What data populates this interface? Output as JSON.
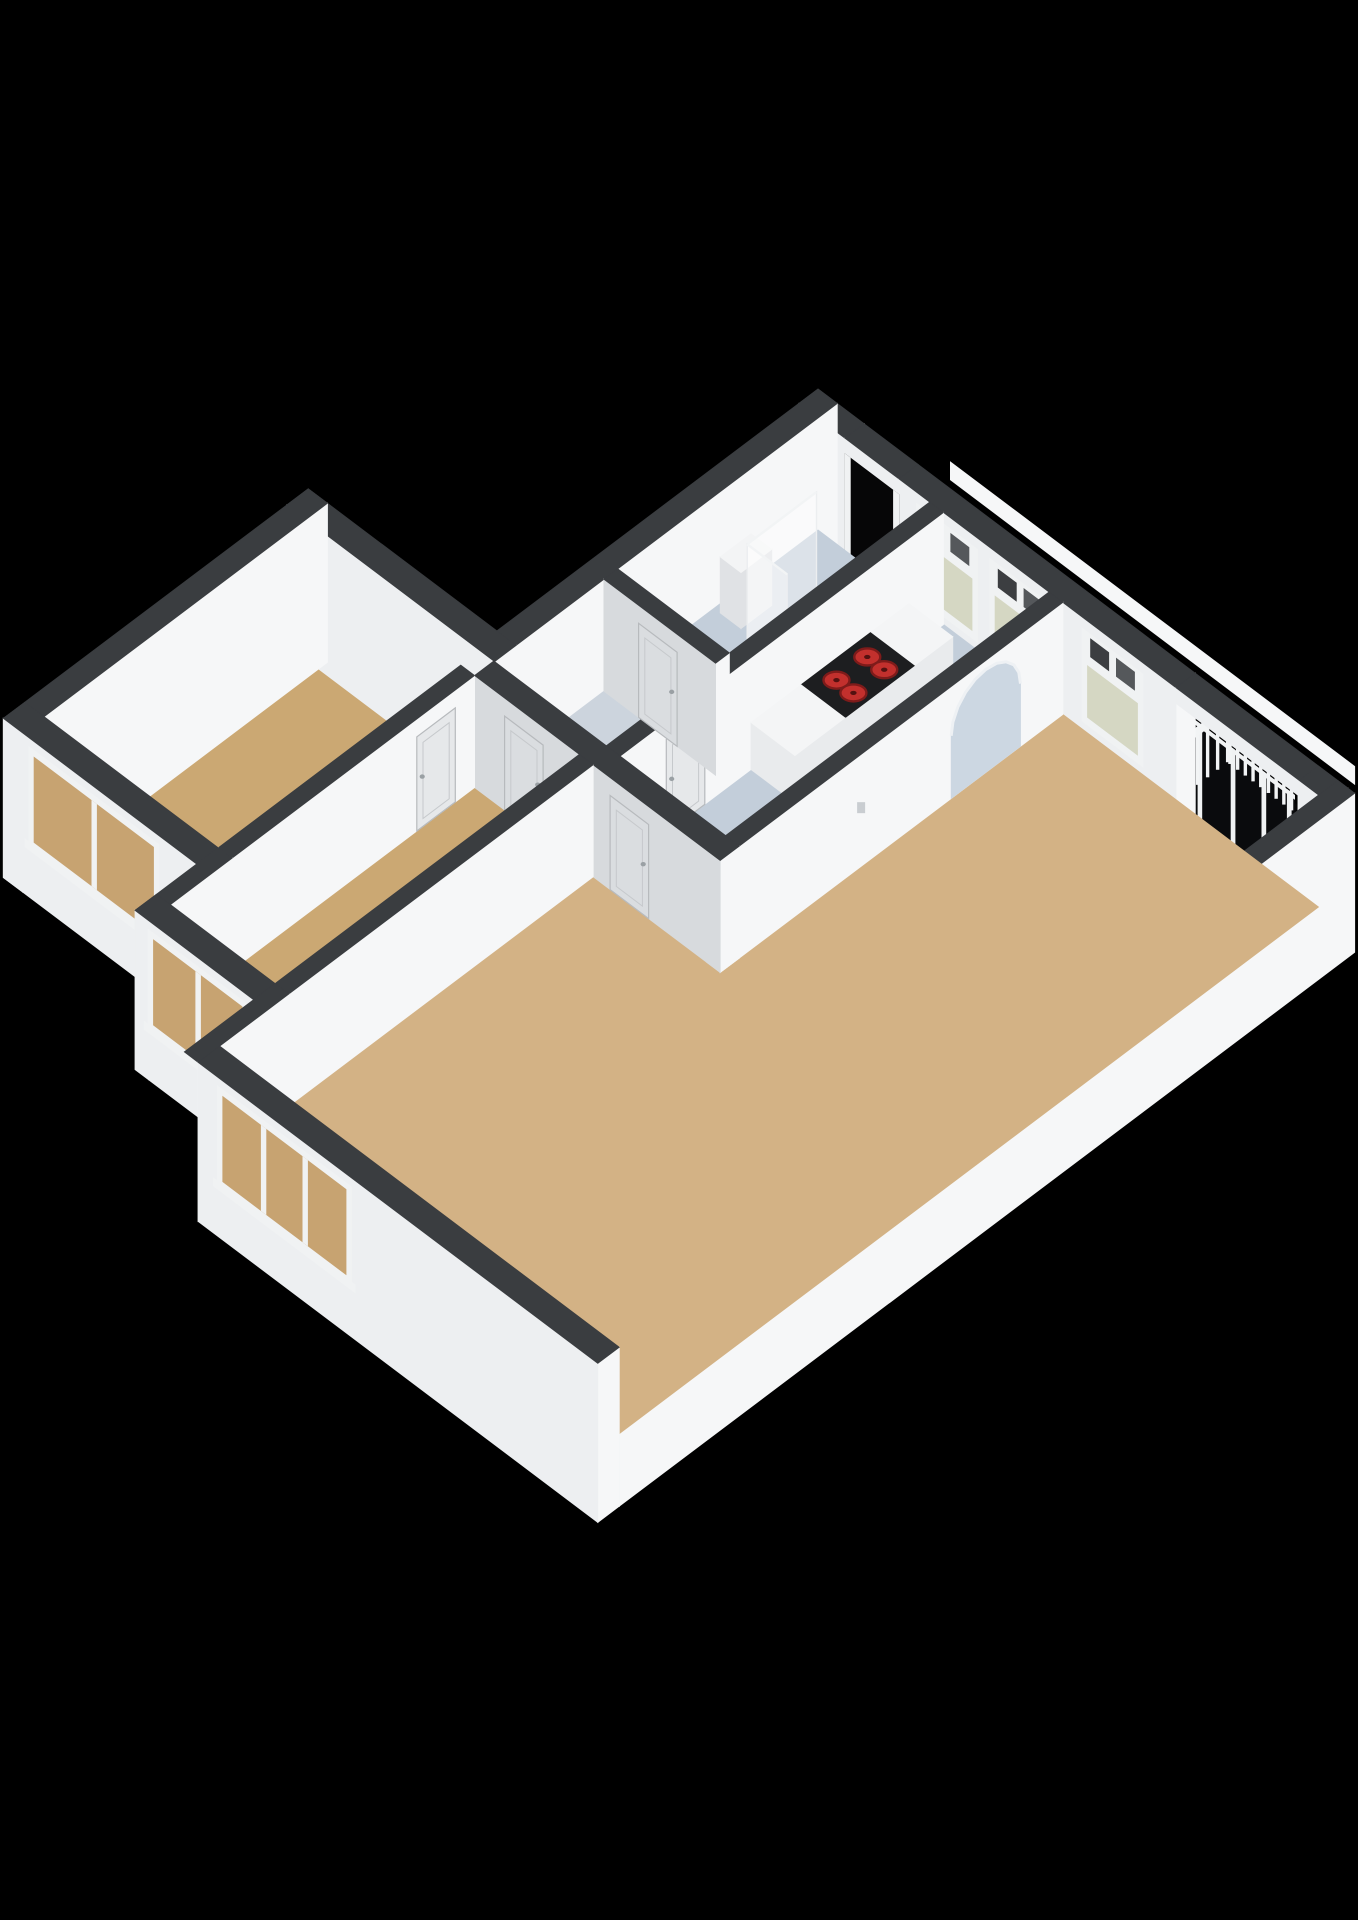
{
  "colors": {
    "background": "#000000",
    "wall_top": "#3a3d40",
    "wall_top_inner": "#43464a",
    "face_bright": "#f6f7f8",
    "face_light": "#edeff1",
    "face_side": "#e2e4e7",
    "face_gray": "#d7dadd",
    "floor_living": "#d3b285",
    "floor_bedroom": "#cba873",
    "floor_kitchen": "#c3ceda",
    "floor_hall": "#ccd4dd",
    "glass_frosted": "#d5d7c3",
    "glass_interior": "#c7a371",
    "glass_dark": "#0a0b0d",
    "frame_white": "#f0f2f3",
    "opening_black": "#060607",
    "railing_white": "#f2f4f5",
    "counter_white": "#f4f5f6",
    "counter_face": "#e9ebed",
    "cooktop_black": "#1d1e20",
    "burner_red": "#c2302d",
    "burner_dark": "#7e1b1a",
    "arch_fill": "#ccd7e2",
    "door_face": "#e6e8ea",
    "door_face_gray": "#dadde0",
    "door_line": "#b7babd",
    "fixture_white": "#f3f4f5",
    "fixture_side": "#e0e2e5",
    "shower_glass": "rgba(255,255,255,0.42)"
  },
  "floorplan": {
    "projection": {
      "origin_x": 818,
      "origin_y": 530,
      "ex": [
        77,
        58
      ],
      "ey": [
        -77,
        58
      ],
      "wall_h": 112
    },
    "rooms": [
      "living-room",
      "bedroom-1",
      "bedroom-2",
      "kitchen",
      "bathroom",
      "hallway",
      "french-balcony",
      "entrance"
    ],
    "ledge": {
      "name": "exterior-gallery-ledge",
      "y": -0.52,
      "x": [
        1.2,
        6.45
      ],
      "z": [
        0.8,
        0.96
      ],
      "fill": "face_bright"
    },
    "balcony": {
      "floor": {
        "name": "floor-balcony",
        "poly": [
          [
            4.65,
            -0.72
          ],
          [
            6.25,
            -0.72
          ],
          [
            6.25,
            0
          ],
          [
            4.65,
            0
          ]
        ],
        "fill": "opening_black"
      },
      "glass": {
        "y": 0.06,
        "x": [
          4.65,
          6.25
        ],
        "z": [
          0,
          0.9
        ],
        "fill": "glass_dark",
        "frames": [
          4.65,
          5.02,
          5.45,
          5.85,
          6.18
        ],
        "frame_w": 0.05
      },
      "rail_z": [
        0.06,
        0.5
      ],
      "cap_z": [
        0.5,
        0.58
      ],
      "rail_front": {
        "y": -0.6,
        "x": [
          4.75,
          6.15
        ],
        "posts": 15
      },
      "rail_side": {
        "x": 4.72,
        "y": [
          -0.6,
          -0.08
        ],
        "posts": 5
      }
    },
    "entrance_opening": {
      "y": 0,
      "x": [
        0.35,
        1.05
      ],
      "z": [
        0,
        0.86
      ],
      "fill": "opening_black",
      "jamb_w": 0.07
    },
    "back_walls": [
      {
        "name": "wall-ne-facade-a",
        "rect": [
          -0.25,
          -0.25,
          0.35,
          0
        ],
        "zb": -0.42,
        "fx": true,
        "fy": true
      },
      {
        "name": "wall-ne-header-entrance",
        "rect": [
          0.35,
          -0.25,
          1.05,
          0
        ],
        "zb": 0.86,
        "fx": false,
        "fy": true
      },
      {
        "name": "wall-ne-facade-b",
        "rect": [
          1.05,
          -0.25,
          4.65,
          0
        ],
        "zb": -0.42,
        "fx": true,
        "fy": true,
        "windows": [
          {
            "face": "fy",
            "r": [
              1.35,
              2.0
            ],
            "z": [
              0.14,
              0.6
            ],
            "glass": "glass_frosted",
            "mullions": [],
            "transom": true
          },
          {
            "face": "fy",
            "r": [
              2.3,
              2.95
            ],
            "z": [
              0.14,
              0.6
            ],
            "glass": "glass_frosted",
            "mullions": [],
            "transom": true
          },
          {
            "face": "fy",
            "r": [
              3.5,
              4.15
            ],
            "z": [
              0.14,
              0.6
            ],
            "glass": "glass_frosted",
            "mullions": [],
            "transom": true
          }
        ]
      },
      {
        "name": "wall-ne-header-balcony",
        "rect": [
          4.65,
          -0.25,
          6.25,
          0
        ],
        "zb": 0.86,
        "fx": false,
        "fy": true
      },
      {
        "name": "wall-ne-facade-c",
        "rect": [
          6.25,
          -0.25,
          6.63,
          0
        ],
        "zb": -0.42,
        "fx": true,
        "fy": true
      },
      {
        "name": "wall-nw-facade",
        "rect": [
          -0.25,
          -0.25,
          0,
          4.2
        ],
        "zb": -0.42,
        "fx": true,
        "fy": true
      },
      {
        "name": "wall-wing-ne-facade",
        "rect": [
          -2.7,
          3.92,
          0,
          4.2
        ],
        "zb": -0.42,
        "fx": true,
        "fy": true
      },
      {
        "name": "wall-se-facade",
        "rect": [
          6.5,
          -0.25,
          6.72,
          9.3
        ],
        "zb": -0.42,
        "fx": true,
        "fy": true
      }
    ],
    "floors": [
      {
        "name": "floor-living-room",
        "fill": "floor_living",
        "poly": [
          [
            3.18,
            0
          ],
          [
            6.5,
            0
          ],
          [
            6.5,
            9.3
          ],
          [
            1.53,
            9.3
          ],
          [
            1.53,
            4.45
          ],
          [
            3.18,
            4.45
          ]
        ]
      },
      {
        "name": "floor-bedroom-1",
        "fill": "floor_bedroom",
        "poly": [
          [
            -2.45,
            4.45
          ],
          [
            -0.19,
            4.45
          ],
          [
            -0.19,
            7.6
          ],
          [
            -2.45,
            7.6
          ]
        ]
      },
      {
        "name": "floor-bedroom-2",
        "fill": "floor_bedroom",
        "poly": [
          [
            -0.01,
            4.45
          ],
          [
            1.35,
            4.45
          ],
          [
            1.35,
            8.4
          ],
          [
            -0.01,
            8.4
          ]
        ]
      },
      {
        "name": "floor-kitchen",
        "fill": "floor_kitchen",
        "poly": [
          [
            1.63,
            0
          ],
          [
            3.0,
            0
          ],
          [
            3.0,
            4.2
          ],
          [
            1.63,
            4.2
          ]
        ]
      },
      {
        "name": "floor-bathroom",
        "fill": "floor_kitchen",
        "poly": [
          [
            0,
            0
          ],
          [
            1.45,
            0
          ],
          [
            1.45,
            2.6
          ],
          [
            0,
            2.6
          ]
        ]
      },
      {
        "name": "floor-hallway",
        "fill": "floor_hall",
        "poly": [
          [
            0,
            2.6
          ],
          [
            1.45,
            2.6
          ],
          [
            1.45,
            4.2
          ],
          [
            0,
            4.2
          ]
        ]
      }
    ],
    "fixtures": {
      "sink": {
        "name": "sink",
        "rect": [
          0.08,
          0.95,
          0.35,
          1.35
        ],
        "zt": 0.5
      },
      "toilet": {
        "name": "toilet",
        "rect": [
          1.1,
          0.4,
          1.38,
          0.78
        ],
        "zt": 0.42,
        "lid": [
          1.24,
          0.59
        ]
      },
      "shower_panes": [
        {
          "name": "shower-glass-panel",
          "plane": "fx",
          "x": 0.58,
          "r": [
            0.6,
            1.5
          ],
          "z": [
            0,
            0.95
          ]
        },
        {
          "name": "shower-glass-return",
          "plane": "fy",
          "y": 1.5,
          "r": [
            0.58,
            1.1
          ],
          "z": [
            0,
            0.95
          ]
        }
      ],
      "counter": {
        "name": "kitchen-counter",
        "boxes": [
          {
            "name": "counter-cabinet-a",
            "rect": [
              1.63,
              0.45,
              2.2,
              0.95
            ],
            "zt": 0.42,
            "top": "counter_white"
          },
          {
            "name": "counter-cooktop",
            "rect": [
              1.63,
              0.95,
              2.2,
              1.85
            ],
            "zt": 0.42,
            "top": "cooktop_black"
          },
          {
            "name": "counter-cabinet-b",
            "rect": [
              1.63,
              1.85,
              2.2,
              2.5
            ],
            "zt": 0.42,
            "top": "counter_white"
          }
        ],
        "burners": [
          [
            1.82,
            1.18
          ],
          [
            2.04,
            1.18
          ],
          [
            1.82,
            1.58
          ],
          [
            2.04,
            1.58
          ]
        ]
      }
    },
    "interior_walls": [
      {
        "name": "wall-bathroom-kitchen",
        "rect": [
          1.45,
          0,
          1.63,
          4.2
        ],
        "zb": 0,
        "fx": true,
        "fy": true,
        "doors": [
          {
            "face": "fx",
            "r": [
              3.1,
              3.6
            ],
            "z": [
              0,
              0.84
            ]
          }
        ]
      },
      {
        "name": "wall-bathroom-hall",
        "rect": [
          0,
          2.6,
          1.45,
          2.78
        ],
        "zb": 0,
        "fx": true,
        "fy": true,
        "doors": [
          {
            "face": "fy",
            "r": [
              0.45,
              0.95
            ],
            "z": [
              0,
              0.84
            ]
          }
        ]
      },
      {
        "name": "wall-arch",
        "rect": [
          3.0,
          0,
          3.18,
          4.45
        ],
        "zb": 0,
        "fx": true,
        "fy": true,
        "arch": {
          "face": "fx",
          "center": 1.0,
          "half": 0.45,
          "z_rect": 0.56,
          "rz": 0.36
        },
        "thermostat": {
          "y": 2.62,
          "z": 0.52
        }
      },
      {
        "name": "wall-hall-bedrooms",
        "rect": [
          -0.01,
          4.2,
          3.18,
          4.45
        ],
        "zb": 0,
        "fx": true,
        "fy": true,
        "doors": [
          {
            "face": "fy",
            "r": [
              0.38,
              0.88
            ],
            "z": [
              0,
              0.84
            ]
          },
          {
            "face": "fy",
            "r": [
              1.75,
              2.25
            ],
            "z": [
              0,
              0.84
            ]
          }
        ]
      },
      {
        "name": "wall-bedroom-divider",
        "rect": [
          -0.19,
          4.45,
          -0.01,
          8.4
        ],
        "zb": 0,
        "fx": true,
        "fy": false,
        "doors": [
          {
            "face": "fx",
            "r": [
              4.7,
              5.2
            ],
            "z": [
              0,
              0.84
            ]
          }
        ]
      },
      {
        "name": "wall-bedroom2-living",
        "rect": [
          1.35,
          4.45,
          1.53,
          8.4
        ],
        "zb": 0,
        "fx": true,
        "fy": false
      }
    ],
    "front_walls": [
      {
        "name": "wall-wing-west-facade",
        "rect": [
          -2.7,
          3.92,
          -2.45,
          7.88
        ],
        "zb": -0.42,
        "fx": true,
        "fy": true
      },
      {
        "name": "wall-wing-sw-facade",
        "rect": [
          -2.7,
          7.6,
          -0.19,
          7.88
        ],
        "zb": -0.42,
        "fx": true,
        "fy": true,
        "windows": [
          {
            "face": "fy",
            "r": [
              -2.3,
              -0.75
            ],
            "z": [
              0.1,
              0.86
            ],
            "glass": "glass_interior",
            "mullions": [
              -1.52
            ],
            "transom": false
          }
        ]
      },
      {
        "name": "wall-step-bedroom1-2",
        "rect": [
          -0.19,
          7.6,
          -0.01,
          8.68
        ],
        "zb": -0.42,
        "fx": true,
        "fy": false
      },
      {
        "name": "wall-bedroom2-sw-facade",
        "rect": [
          -0.19,
          8.4,
          1.35,
          8.68
        ],
        "zb": -0.42,
        "fx": true,
        "fy": true,
        "windows": [
          {
            "face": "fy",
            "r": [
              0.05,
              1.2
            ],
            "z": [
              0.1,
              0.86
            ],
            "glass": "glass_interior",
            "mullions": [
              0.63
            ],
            "transom": false
          }
        ]
      },
      {
        "name": "wall-step-bedroom2-living",
        "rect": [
          1.35,
          8.4,
          1.53,
          9.58
        ],
        "zb": -0.42,
        "fx": true,
        "fy": false
      },
      {
        "name": "wall-living-sw-facade",
        "rect": [
          1.53,
          9.3,
          6.72,
          9.58
        ],
        "zb": -0.42,
        "fx": true,
        "fy": true,
        "windows": [
          {
            "face": "fy",
            "r": [
              1.85,
              3.45
            ],
            "z": [
              0.1,
              0.86
            ],
            "glass": "glass_interior",
            "mullions": [
              2.38,
              2.92
            ],
            "transom": false
          }
        ]
      }
    ]
  }
}
